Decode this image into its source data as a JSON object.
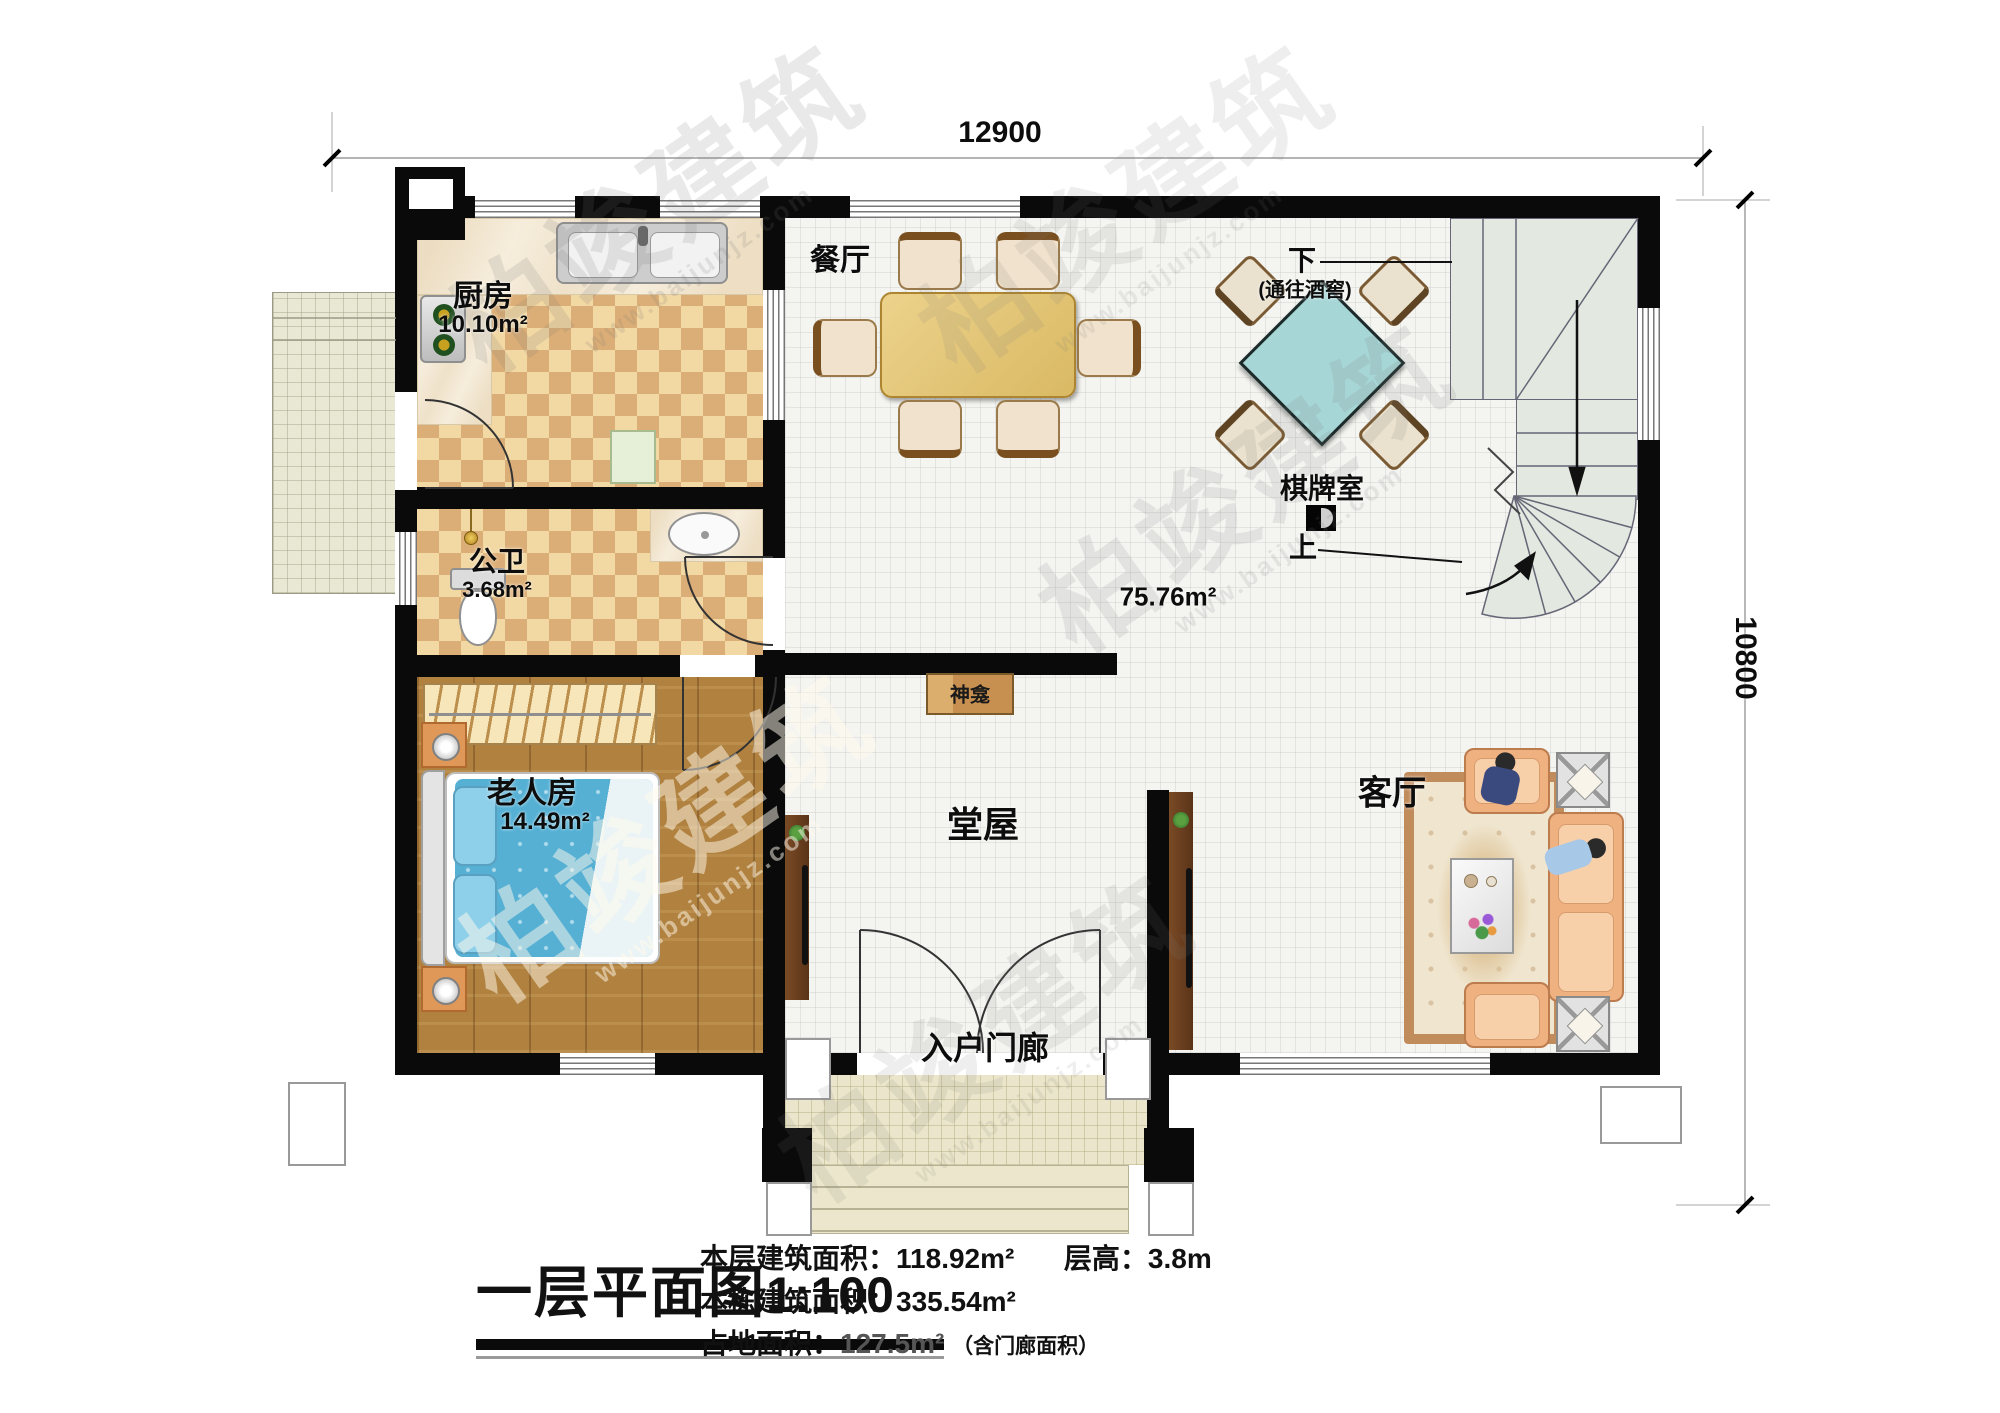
{
  "plan": {
    "dim_top": "12900",
    "dim_right": "10800",
    "rooms": {
      "dining": {
        "name": "餐厅"
      },
      "kitchen": {
        "name": "厨房",
        "area": "10.10m²"
      },
      "bath": {
        "name": "公卫",
        "area": "3.68m²"
      },
      "elder": {
        "name": "老人房",
        "area": "14.49m²"
      },
      "hall": {
        "name": "堂屋"
      },
      "living": {
        "name": "客厅"
      },
      "chess": {
        "name": "棋牌室"
      },
      "porch": {
        "name": "入户门廊"
      },
      "shrine": {
        "name": "神龛"
      },
      "open_area": "75.76m²"
    },
    "stairs": {
      "down": "下",
      "down_note": "(通往酒窖)",
      "up": "上"
    }
  },
  "titleblock": {
    "title": "一层平面图",
    "scale": "1:100",
    "stats": [
      {
        "label": "本层建筑面积：",
        "value": "118.92m²",
        "label2": "层高：",
        "value2": "3.8m"
      },
      {
        "label": "本栋建筑面积：",
        "value": "335.54m²"
      },
      {
        "label": "占地面积：",
        "value": "127.5m²",
        "note": "（含门廊面积）"
      }
    ]
  },
  "watermark": {
    "brand": "柏竣建筑",
    "url": "www.baijunjz.com"
  }
}
